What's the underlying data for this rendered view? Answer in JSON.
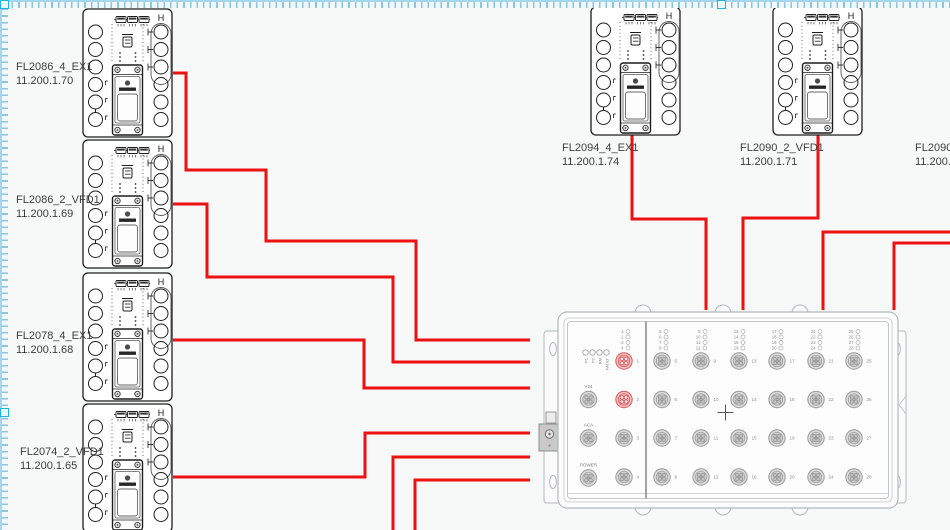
{
  "canvas": {
    "background": "#f7f8f8"
  },
  "colors": {
    "cable": "#ee1111",
    "device_outline": "#1d1d1f",
    "switch_outline": "#b4b8ba",
    "label_text": "#3e3e3e",
    "selection_handle": "#19b5e8"
  },
  "devices": [
    {
      "name": "FL2086_4_EX1",
      "ip": "11.200.1.70"
    },
    {
      "name": "FL2086_2_VFD1",
      "ip": "11.200.1.69"
    },
    {
      "name": "FL2078_4_EX1",
      "ip": "11.200.1.68"
    },
    {
      "name": "FL2074_2_VFD1",
      "ip": "11.200.1.65"
    },
    {
      "name": "FL2094_4_EX1",
      "ip": "11.200.1.74"
    },
    {
      "name": "FL2090_2_VFD1",
      "ip": "11.200.1.71"
    },
    {
      "name": "FL2090_4",
      "ip": "11.200.1."
    }
  ],
  "switch": {
    "status_leds": [
      "P1",
      "P2",
      "RM",
      "FAULT"
    ],
    "connectors": [
      "V24",
      "ACA",
      "POWER"
    ],
    "port_columns": [
      [
        1,
        2,
        3,
        4
      ],
      [
        5,
        6,
        7,
        8
      ],
      [
        9,
        10,
        11,
        12
      ],
      [
        13,
        14,
        15,
        16
      ],
      [
        17,
        18,
        19,
        20
      ],
      [
        21,
        22,
        23,
        24
      ],
      [
        25,
        26,
        27,
        28
      ]
    ],
    "highlighted_ports": [
      1,
      2
    ]
  }
}
